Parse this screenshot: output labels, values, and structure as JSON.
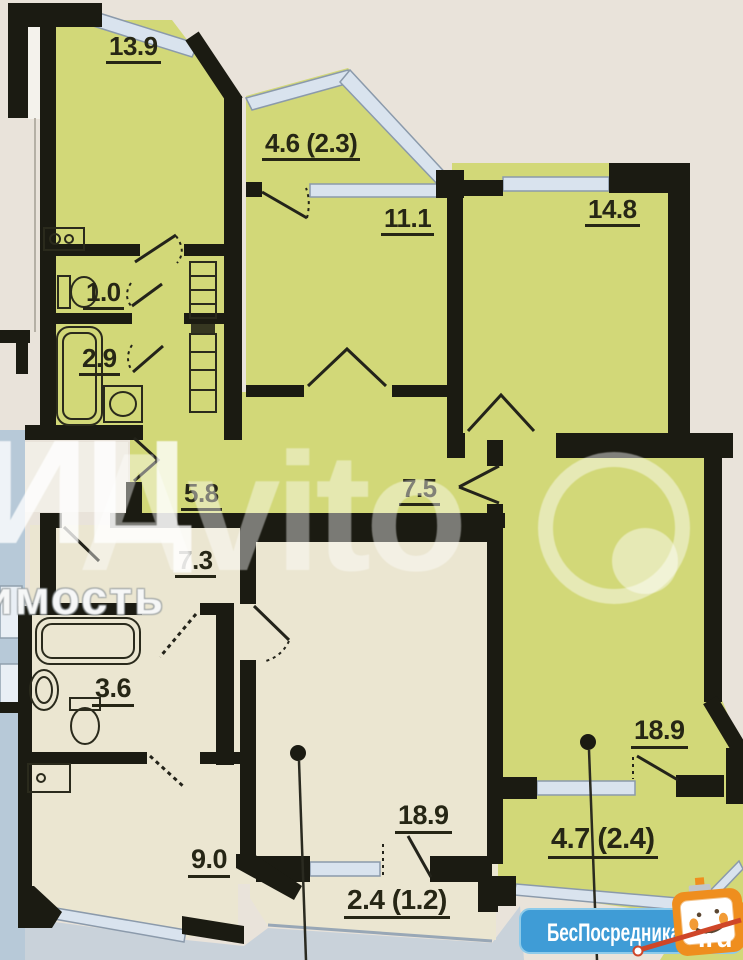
{
  "rooms": [
    {
      "id": "room-13-9",
      "area": "13.9"
    },
    {
      "id": "balcony-4-6",
      "area": "4.6 (2.3)"
    },
    {
      "id": "room-11-1",
      "area": "11.1"
    },
    {
      "id": "room-14-8",
      "area": "14.8"
    },
    {
      "id": "wc-1-0",
      "area": "1.0"
    },
    {
      "id": "bathroom-2-9",
      "area": "2.9"
    },
    {
      "id": "hallway-5-8",
      "area": "5.8"
    },
    {
      "id": "corridor-7-5",
      "area": "7.5"
    },
    {
      "id": "corridor-7-3",
      "area": "7.3"
    },
    {
      "id": "bathroom-3-6",
      "area": "3.6"
    },
    {
      "id": "room-9-0",
      "area": "9.0"
    },
    {
      "id": "room-18-9-center",
      "area": "18.9"
    },
    {
      "id": "balcony-2-4",
      "area": "2.4 (1.2)"
    },
    {
      "id": "room-18-9-right",
      "area": "18.9"
    },
    {
      "id": "balcony-4-7",
      "area": "4.7 (2.4)"
    }
  ],
  "watermarks": {
    "agency_letters": "ИЦ",
    "agency_word": "имость",
    "portal": "Avito"
  },
  "logo": {
    "name": "БесПосредника",
    "tld": ".ru"
  },
  "colors": {
    "room_green": "#d2d878",
    "room_cream": "#ebe6d1",
    "wall": "#1b1b12",
    "window": "#d9e3ee",
    "outside": "#c9d2da",
    "paper": "#e9e3da",
    "logo_blue": "#3f9cd6",
    "mascot_orange": "#ef8e1e",
    "pointer_red": "#cf4628"
  }
}
